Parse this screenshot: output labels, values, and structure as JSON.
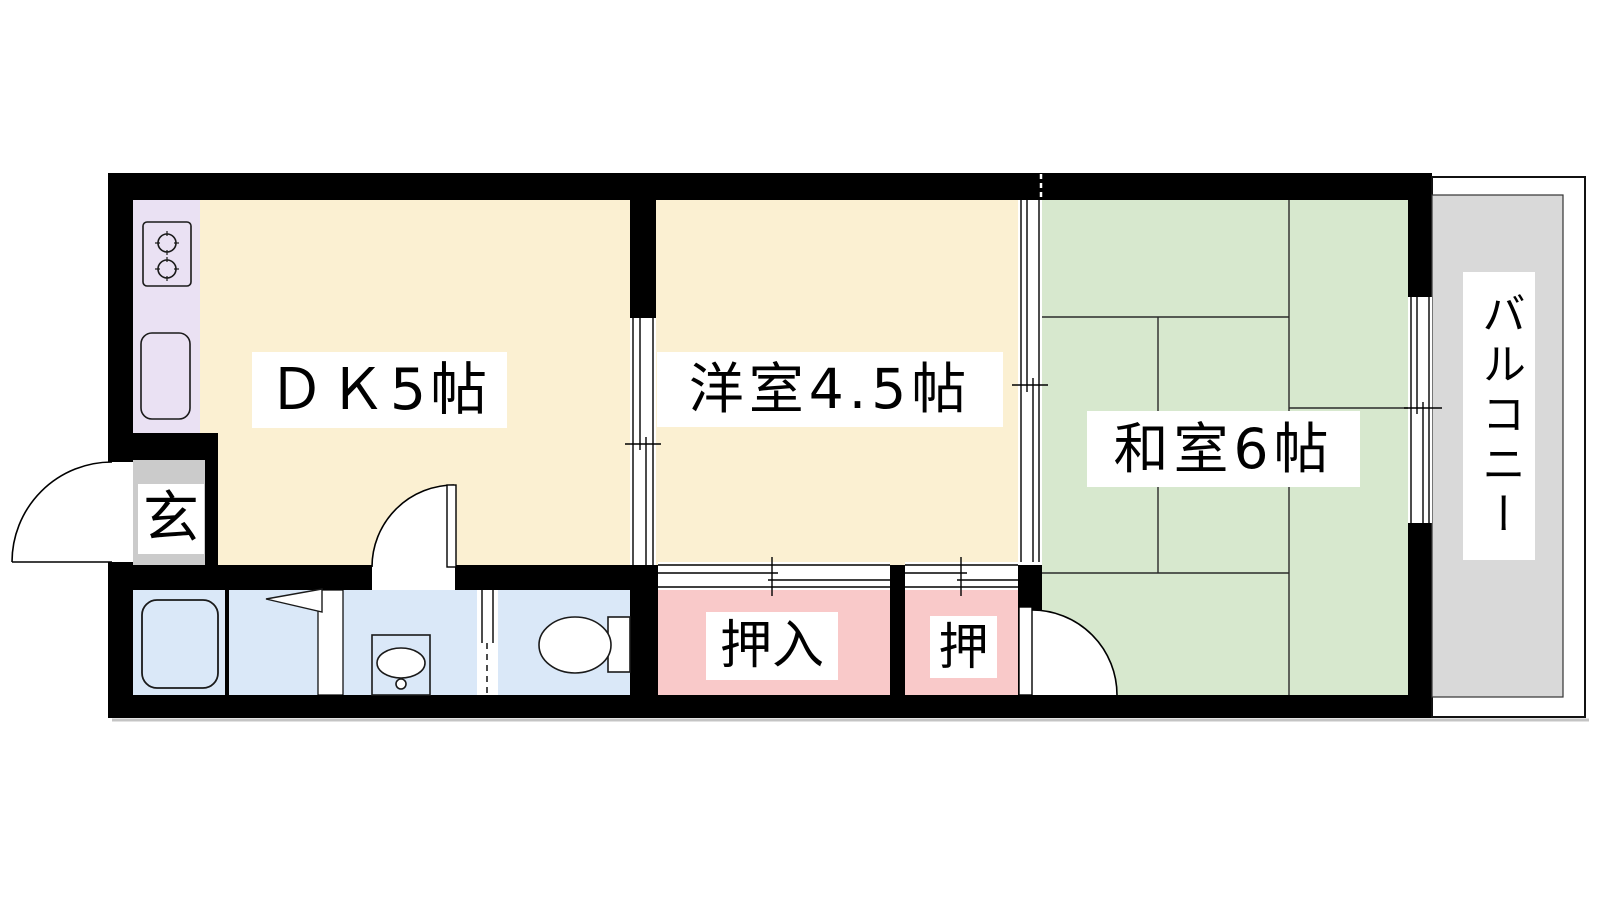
{
  "document": {
    "kind": "apartment-floor-plan"
  },
  "rooms": [
    {
      "id": "dining-kitchen",
      "label": "ＤＫ5帖",
      "size_jo": "5"
    },
    {
      "id": "western-room",
      "label": "洋室4.5帖",
      "size_jo": "4.5"
    },
    {
      "id": "japanese-room",
      "label": "和室6帖",
      "size_jo": "6"
    },
    {
      "id": "balcony",
      "label": "バルコニー"
    },
    {
      "id": "entrance",
      "label": "玄"
    },
    {
      "id": "closet-oshiire",
      "label": "押入"
    },
    {
      "id": "closet-oshi",
      "label": "押"
    }
  ],
  "fixtures": [
    {
      "name": "gas-stove-2-burner-icon"
    },
    {
      "name": "kitchen-sink-icon"
    },
    {
      "name": "bathtub-icon"
    },
    {
      "name": "folding-door-icon"
    },
    {
      "name": "washbasin-icon"
    },
    {
      "name": "toilet-icon"
    },
    {
      "name": "entrance-door-swing-icon"
    },
    {
      "name": "interior-door-swing-icon"
    },
    {
      "name": "japanese-room-door-swing-icon"
    },
    {
      "name": "sliding-door-icon"
    },
    {
      "name": "sliding-window-icon"
    },
    {
      "name": "closet-fusuma-icon"
    }
  ],
  "colors": {
    "wall": "#000000",
    "cream": "#FBF0D2",
    "green": "#D7E8CE",
    "lavender": "#EAE1F3",
    "pink": "#F9C9C9",
    "blue": "#DAE8F8",
    "genkan": "#CBCBCB",
    "balcony": "#D9D9D9",
    "label_bg": "#FFFFFF",
    "line": "#000000",
    "shadow": "#C4C4C4"
  }
}
